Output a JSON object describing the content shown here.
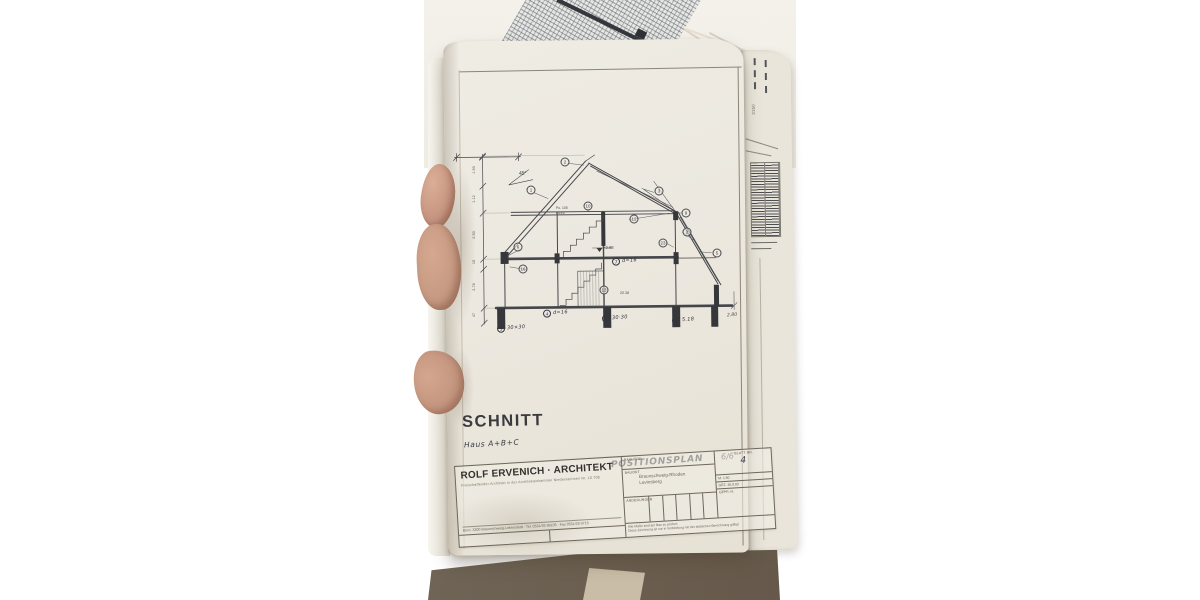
{
  "photo": {
    "background_color": "#ffffff",
    "table_color": "#6c6153",
    "page_color": "#ece8df"
  },
  "sheet": {
    "drawing_title": "SCHNITT",
    "drawing_subtitle": "Haus A+B+C",
    "plan_label": "POSITIONSPLAN",
    "sheet_number": "6/6"
  },
  "section_drawing": {
    "angle_label": "45°",
    "level_label": "+2.98",
    "stair_note_line1": "Po. 105",
    "stair_note_line2": "40/16",
    "span_label": "20.38",
    "outer_dim_label": "2.80",
    "left_dims": [
      {
        "v": "1.93",
        "y": 170
      },
      {
        "v": "1.12",
        "y": 199
      },
      {
        "v": "2.50",
        "y": 235
      },
      {
        "v": "15",
        "y": 262
      },
      {
        "v": "2.76",
        "y": 287
      },
      {
        "v": "47",
        "y": 315
      }
    ],
    "position_circles": [
      {
        "n": "2",
        "x": 565,
        "y": 162
      },
      {
        "n": "1",
        "x": 531,
        "y": 190
      },
      {
        "n": "6",
        "x": 518,
        "y": 247
      },
      {
        "n": "16",
        "x": 523,
        "y": 269
      },
      {
        "n": "10",
        "x": 588,
        "y": 206
      },
      {
        "n": "12",
        "x": 634,
        "y": 219
      },
      {
        "n": "3",
        "x": 659,
        "y": 191
      },
      {
        "n": "9",
        "x": 686,
        "y": 213
      },
      {
        "n": "2",
        "x": 687,
        "y": 232
      },
      {
        "n": "23",
        "x": 663,
        "y": 243
      },
      {
        "n": "5",
        "x": 717,
        "y": 253
      },
      {
        "n": "13",
        "x": 604,
        "y": 290
      }
    ],
    "callout_labels": [
      {
        "circle": "5",
        "text": "30×30",
        "x": 497,
        "y": 324
      },
      {
        "circle": "4",
        "text": "d=16",
        "x": 543,
        "y": 309
      },
      {
        "circle": "4",
        "text": "30·30",
        "x": 602,
        "y": 314
      },
      {
        "circle": "8",
        "text": "5.18",
        "x": 672,
        "y": 316
      },
      {
        "circle": "7",
        "text": "d=16",
        "x": 612,
        "y": 257
      }
    ]
  },
  "neighbor_sheet": {
    "dim_label": "3150"
  },
  "titleblock": {
    "architect_name": "ROLF ERVENICH · ARCHITEKT",
    "architect_subline": "Freischaffender Architekt in der Architektenkammer Niedersachsen Nr. 10.706",
    "address_line": "Büro: 3300 Braunschweig-Lebenstedt · Tel. 0531/35 98105 · Fax 0531/28 9715",
    "labels": {
      "bauherr": "BAUHERR",
      "bauort": "BAUORT",
      "aenderungen": "ÄNDERUNGEN",
      "blatt_nr": "BLATT NR."
    },
    "blatt_nr_value": "4",
    "bauort_line1": "Braunschweig-Rhoden",
    "bauort_line2": "Levinsberg",
    "scale": "M. 1:50",
    "gez": "GEZ. 30.8.93",
    "gepr": "GEPR. N.",
    "note_line1": "Alle Maße sind am Bau zu prüfen!",
    "note_line2": "Diese Zeichnung ist nur in Verbindung mit der statischen Berechnung gültig!"
  }
}
